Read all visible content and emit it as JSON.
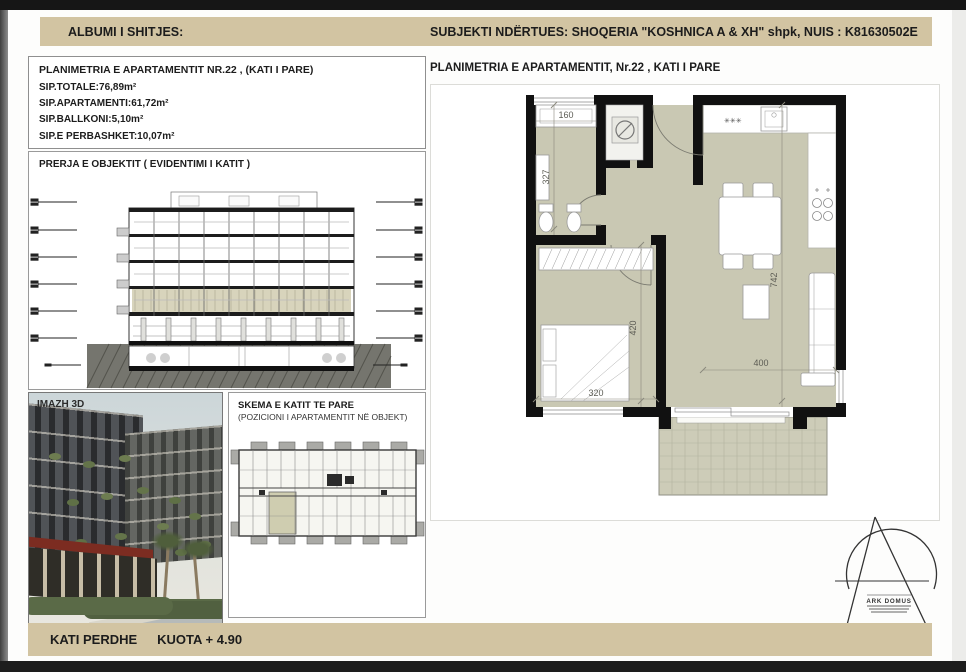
{
  "header": {
    "left": "ALBUMI I SHITJES:",
    "right": "SUBJEKTI NDËRTUES:  SHOQERIA \"KOSHNICA A & XH\" shpk, NUIS : K81630502E"
  },
  "info_box": {
    "title": "PLANIMETRIA E APARTAMENTIT NR.22 , (KATI I PARE)",
    "lines": [
      "SIP.TOTALE:76,89m²",
      "SIP.APARTAMENTI:61,72m²",
      "SIP.BALLKONI:5,10m²",
      "SIP.E PERBASHKET:10,07m²"
    ]
  },
  "section_box": {
    "title": "PRERJA E OBJEKTIT ( EVIDENTIMI I KATIT )"
  },
  "image_box": {
    "label": "IMAZH 3D"
  },
  "schema_box": {
    "title": "SKEMA E KATIT TE PARE",
    "subtitle": "(POZICIONI I APARTAMENTIT NË OBJEKT)"
  },
  "plan": {
    "title": "PLANIMETRIA E APARTAMENTIT, Nr.22 , KATI I PARE",
    "dimensions": {
      "bath_width": "160",
      "bath_depth": "327",
      "bedroom_depth": "420",
      "bedroom_width": "320",
      "living_depth": "742",
      "living_width": "400"
    },
    "kitchen_marks": "✳✳✳"
  },
  "logo": {
    "name": "ARK DOMUS"
  },
  "footer": {
    "floor": "KATI PERDHE",
    "quota": "KUOTA + 4.90"
  },
  "colors": {
    "band": "#d2c4a2",
    "floor_fill": "#c9c8b3",
    "balcony_fill": "#cdccb8",
    "highlight_floor": "#d8d4bc",
    "wall": "#111111"
  }
}
